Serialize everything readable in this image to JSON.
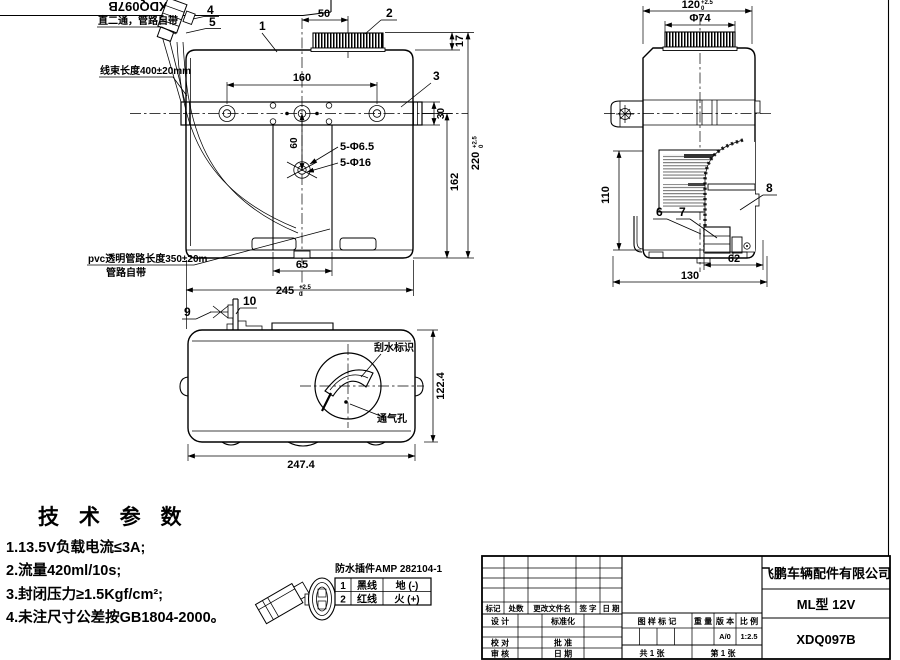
{
  "sheet": {
    "corner_part_no": "XDQ097B"
  },
  "notes": {
    "straight_fitting": "直二通，管路自带",
    "harness_length": "线束长度400±20mm",
    "pvc_line1": "pvc透明管路长度350±20m",
    "pvc_line2": "管路自带"
  },
  "common": {
    "tol_plus": "+2.5",
    "tol_zero": "0"
  },
  "front_view": {
    "callout_1": "1",
    "callout_2": "2",
    "callout_3": "3",
    "callout_4": "4",
    "callout_5": "5",
    "dim_cap_offset": "50",
    "dim_cap_height": "17",
    "dim_hole_spacing": "160",
    "dim_plate_height": "30",
    "dim_hole_drop": "60",
    "dim_body_height": "162",
    "dim_total_height": "220",
    "dim_foot_width": "65",
    "dim_total_width": "245",
    "label_holes_small": "5-Φ6.5",
    "label_holes_large": "5-Φ16"
  },
  "side_view": {
    "callout_6": "6",
    "callout_7": "7",
    "callout_8": "8",
    "dim_depth": "120",
    "dim_cap_dia": "Φ74",
    "dim_lower_height": "110",
    "dim_pump_offset": "62",
    "dim_base_depth": "130"
  },
  "top_view": {
    "callout_9": "9",
    "callout_10": "10",
    "dim_length": "247.4",
    "dim_width": "122.4",
    "label_wiper_mark": "刮水标识",
    "label_vent_hole": "通气孔"
  },
  "tech_params": {
    "title": "技 术 参 数",
    "items": [
      "1.13.5V负载电流≤3A;",
      "2.流量420ml/10s;",
      "3.封闭压力≥1.5Kgf/cm²;",
      "4.未注尺寸公差按GB1804-2000。"
    ]
  },
  "connector": {
    "title": "防水插件AMP 282104-1",
    "rows": [
      {
        "pin": "1",
        "wire": "黑线",
        "function": "地 (-)"
      },
      {
        "pin": "2",
        "wire": "红线",
        "function": "火 (+)"
      }
    ]
  },
  "title_block": {
    "company": "飞鹏车辆配件有限公司",
    "model": "ML型 12V",
    "drawing_no": "XDQ097B",
    "rev_col_1": "标记",
    "rev_col_2": "处数",
    "rev_col_3": "更改文件名",
    "rev_col_4": "签 字",
    "rev_col_5": "日 期",
    "label_design": "设 计",
    "label_standardization": "标准化",
    "label_proofread": "校 对",
    "label_approve": "批 准",
    "label_review": "审 核",
    "label_date": "日 期",
    "label_drawing_mark": "图 样 标 记",
    "label_weight": "重 量",
    "label_version": "版 本",
    "label_scale": "比 例",
    "value_version": "A/0",
    "value_scale": "1:2.5",
    "sheet_total": "共 1 张",
    "sheet_no": "第 1 张"
  }
}
